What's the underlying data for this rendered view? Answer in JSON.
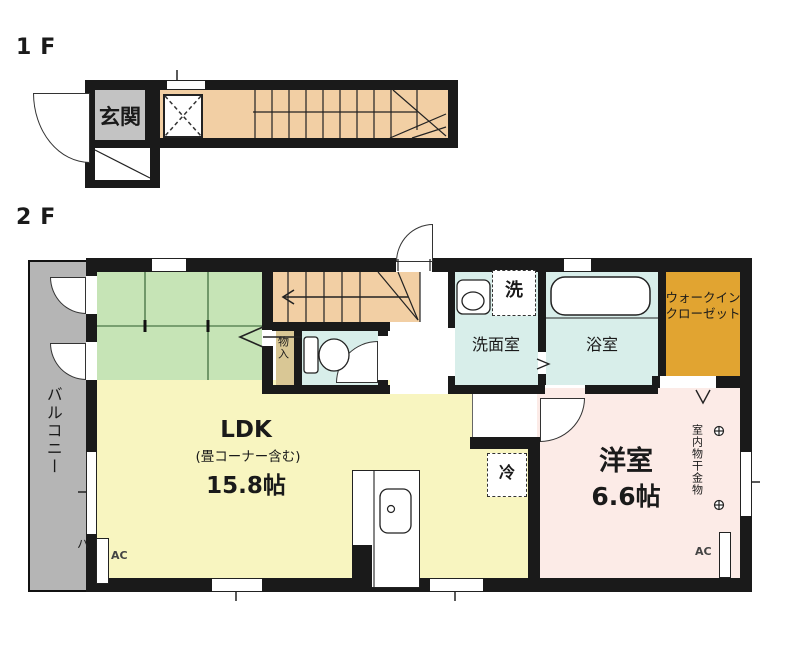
{
  "floor1": {
    "label": "1F",
    "rooms": {
      "entrance": "玄関"
    }
  },
  "floor2": {
    "label": "2F",
    "balcony": {
      "label": "バルコニー",
      "mark": "ハ"
    },
    "ldk": {
      "label": "LDK",
      "note": "(畳コーナー含む)",
      "size": "15.8帖",
      "ac": "AC"
    },
    "storage": {
      "label": "物入"
    },
    "washroom": {
      "label": "洗面室",
      "washer_mark": "洗"
    },
    "bathroom": {
      "label": "浴室"
    },
    "wic": {
      "label_line1": "ウォークイン",
      "label_line2": "クローゼット"
    },
    "bedroom": {
      "label": "洋室",
      "size": "6.6帖",
      "ac": "AC",
      "drying_note": "室内物干金物"
    },
    "fridge_mark": "冷"
  },
  "colors": {
    "wall": "#1a1a1a",
    "tatami": "#c6e4b6",
    "ldk-floor": "#f8f5c0",
    "wet-floor": "#d8eeea",
    "bedroom-floor": "#fcebe7",
    "wic-floor": "#e1a431",
    "stair-floor": "#f2cfa4",
    "balcony": "#b5b5b5",
    "genkan": "#c3c3c3"
  }
}
